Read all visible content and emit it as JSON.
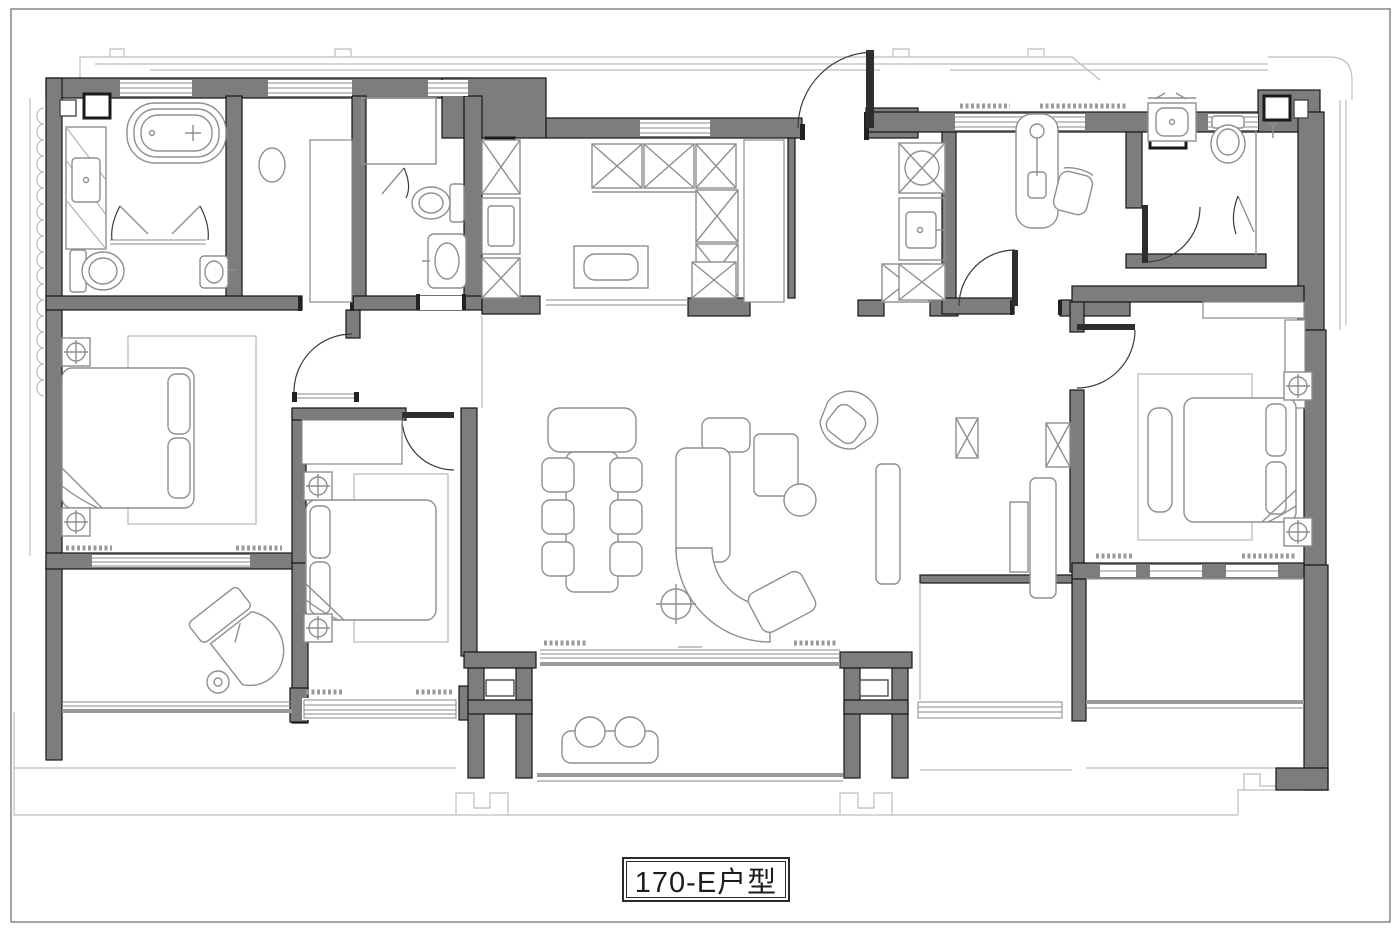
{
  "page": {
    "kind": "architectural-floor-plan",
    "language": "zh-CN"
  },
  "label": {
    "text": "170-E户型"
  },
  "colors": {
    "bg": "#ffffff",
    "wall_fill": "#7d7d7d",
    "wall_stroke": "#161616",
    "fixture": "#8f8f8f",
    "light": "#bdbdbd",
    "accent": "#1a1a1a",
    "sill": "#9a9a9a",
    "label": "#1c1c1c"
  },
  "fixtures": [
    "bathtub-icon",
    "shower-door-icon",
    "toilet-icon",
    "vanity-sink-icon",
    "mirror-icon",
    "kitchen-island-icon",
    "cabinet-x-icon",
    "pantry-shelves-icon",
    "washer-icon",
    "double-bed-icon",
    "pillow-icon",
    "wardrobe-icon",
    "radiator-icon",
    "nightstand-column-icon",
    "dining-table-icon",
    "dining-chair-icon",
    "curved-sofa-icon",
    "coffee-table-icon",
    "armchair-icon",
    "side-table-icon",
    "tv-console-icon",
    "desk-icon",
    "desk-chair-icon",
    "desk-lamp-icon",
    "balcony-bench-icon",
    "stool-icon",
    "door-swing-icon",
    "window-icon",
    "floor-drain-icon",
    "curtain-icon"
  ]
}
